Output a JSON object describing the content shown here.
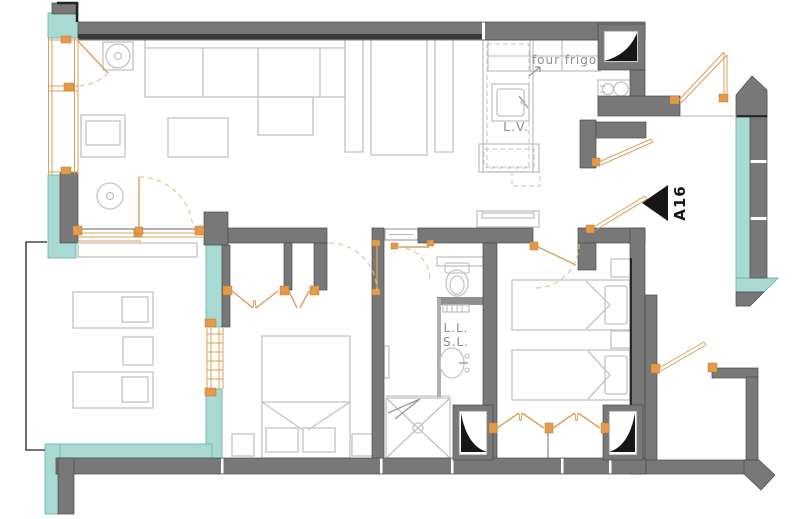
{
  "plan": {
    "unit_label": "A16",
    "labels": {
      "oven": "four",
      "fridge": "frigo",
      "dishwasher": "L.V.",
      "washing_machine": "L.L.",
      "dryer": "S.L."
    }
  },
  "colors": {
    "background": "#ffffff",
    "wall": "#787878",
    "wall_edge": "#4a4a4a",
    "wall_dark": "#3a3a3a",
    "glazing": "#a8dad3",
    "glazing_edge": "#72b5ad",
    "joinery": "#d9a05b",
    "hinge": "#e59a4a",
    "swing": "#dfbe93",
    "furniture": "#c4c4c4",
    "label": "#8f8f8f",
    "black": "#161616"
  }
}
